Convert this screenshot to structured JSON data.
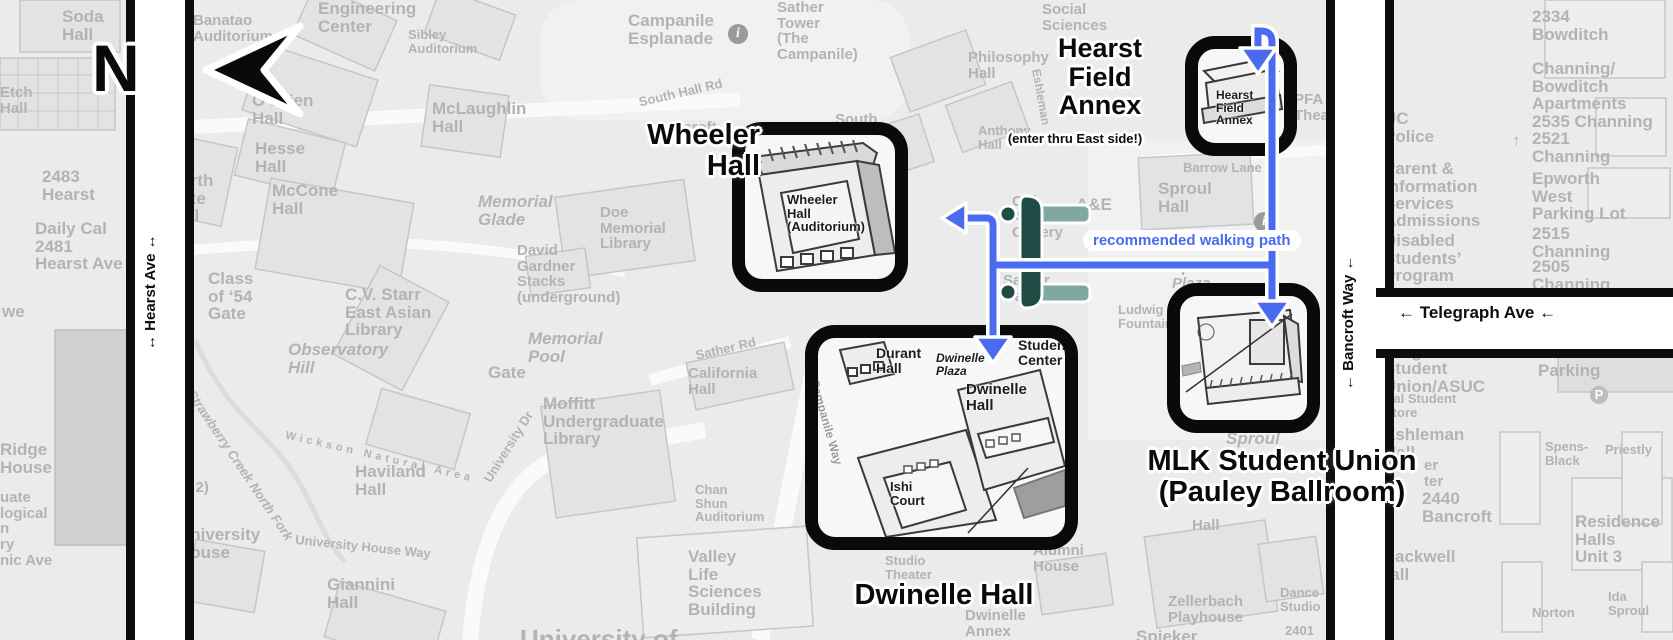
{
  "compass": {
    "letter": "N"
  },
  "roads": {
    "hearst_ave": "↔ Hearst Ave ↔",
    "bancroft_way": "← Bancroft Way ←",
    "telegraph_ave": "← Telegraph Ave ←"
  },
  "walking_path": {
    "label": "recommended walking path",
    "color": "#4a6bf0"
  },
  "callouts": {
    "wheeler": {
      "title": "Wheeler\nHall",
      "building_label": "Wheeler\nHall\n(Auditorium)"
    },
    "hearst_annex": {
      "title": "Hearst\nField\nAnnex",
      "subtitle": "(enter thru East side!)",
      "building_label": "Hearst\nField\nAnnex"
    },
    "dwinelle": {
      "title": "Dwinelle Hall",
      "interior": {
        "durant": "Durant\nHall",
        "plaza": "Dwinelle\nPlaza",
        "dwinelle": "Dwinelle\nHall",
        "ishi": "Ishi\nCourt",
        "student_center": "Student\nCenter",
        "campanile_way": "Campanile Way"
      }
    },
    "mlk": {
      "title": "MLK Student Union\n(Pauley Ballroom)"
    }
  },
  "map_labels": {
    "soda_hall": "Soda\nHall",
    "etch_hall": "Etch\nHall",
    "banatao": "Banatao\nAuditorium",
    "engineering_center": "Engineering\nCenter",
    "sibley": "Sibley\nAuditorium",
    "obrien": "O’Brien\nHall",
    "hesse": "Hesse\nHall",
    "mccone": "McCone\nHall",
    "north_gate": "North\nGate\nHall",
    "class_of_54": "Class\nof ‘54\nGate",
    "mclaughlin": "McLaughlin\nHall",
    "campanile_esplanade": "Campanile\nEsplanade",
    "sather_tower": "Sather\nTower\n(The\nCampanile)",
    "south_hall_rd": "South Hall Rd",
    "south_hall": "South",
    "bancroft_hidden": "Bancroft",
    "memorial_glade": "Memorial\nGlade",
    "gardner_stacks": "David\nGardner\nStacks\n(underground)",
    "doe_library": "Doe\nMemorial\nLibrary",
    "memorial_pool": "Memorial\nPool",
    "gate": "Gate",
    "cv_starr": "C.V. Starr\nEast Asian\nLibrary",
    "observatory_hill": "Observatory\nHill",
    "moffitt": "Moffitt\nUndergraduate\nLibrary",
    "university_dr": "University Dr",
    "sather_rd": "Sather Rd",
    "california_hall": "California\nHall",
    "chan_shun": "Chan\nShun\nAuditorium",
    "vlsb": "Valley\nLife\nSciences\nBuilding",
    "strawberry_creek": "Strawberry Creek North Fork",
    "wickson": "Wickson Natural Area",
    "university_house_way": "University House Way",
    "university_house": "University\nHouse",
    "haviland": "Haviland\nHall",
    "giannini": "Giannini\nHall",
    "philosophy": "Philosophy\nHall",
    "eshleman_rd": "Eshleman",
    "anthony": "Anthony\nHall",
    "old_art_gallery": "Old\nArt\nGallery",
    "ae": "A&E",
    "sather_gate": "Sather\nGate",
    "sproul_hall": "Sproul\nHall",
    "sproul_plaza": "Sproul\nPlaza",
    "ludwig_fountain": "Ludwig\nFountain",
    "barrow_lane": "Barrow Lane",
    "sproul_lower": "Sproul",
    "alumni_house": "Alumni\nHouse",
    "zellerbach_hall_partial": "Hall",
    "zellerbach_playhouse": "Zellerbach\nPlayhouse",
    "dance_studio": "Dance\nStudio",
    "n2401": "2401",
    "spieker": "Spieker",
    "studio_theater": "Studio\nTheater",
    "dwinelle_annex": "Dwinelle\nAnnex",
    "university_of": "University of",
    "social_sciences": "Social\nSciences",
    "pfa_theater": "PFA\nTheater",
    "uc_police": "UC\nPolice",
    "parent_info": "Parent &\nInformation\nServices",
    "admissions": "Admissions",
    "dsp": "Disabled\nStudents’\nProgram",
    "b2334": "2334\nBowditch",
    "channing_bowditch": "Channing/\nBowditch\nApartments\n2535 Channing",
    "arrow_up": "↑",
    "c2521": "2521\nChanning",
    "epworth": "Epworth\nWest\nParking Lot",
    "c2515": "2515\nChanning",
    "c2505": "2505\nChanning",
    "mlk_asuc": "Martin Luther\nKing Jr.\nStudent\nUnion/ASUC",
    "cal_student_store": "Cal Student\nStore",
    "eshleman_hall": "Eshleman\nHall",
    "partial_er": "er\nter",
    "b2440": "2440\nBancroft",
    "blackwell": "Blackwell\nHall",
    "public_parking": "Public\nParking",
    "spens_black": "Spens-\nBlack",
    "priestly": "Priestly",
    "residence_halls": "Residence\nHalls\nUnit 3",
    "norton": "Norton",
    "ida_sproul": "Ida\nSproul",
    "ridge_house": "Ridge\nHouse",
    "we_partial": "we",
    "grad_partial": "uate\nlogical\nn\nry",
    "scenic_ave": "nic Ave",
    "parking_partial": "er\nst\ning\ncture\n(Level 2)",
    "hearst_2483": "2483\nHearst",
    "daily_cal": "Daily Cal\n2481\nHearst Ave",
    "info_i": "i",
    "parking_p": "P"
  },
  "colors": {
    "path_blue": "#4a6bf0",
    "gate_dark_teal": "#1f4b45",
    "gate_light_teal": "#80a8a1",
    "map_label_gray": "#b3b3b3",
    "road_black": "#0d0d0d"
  }
}
